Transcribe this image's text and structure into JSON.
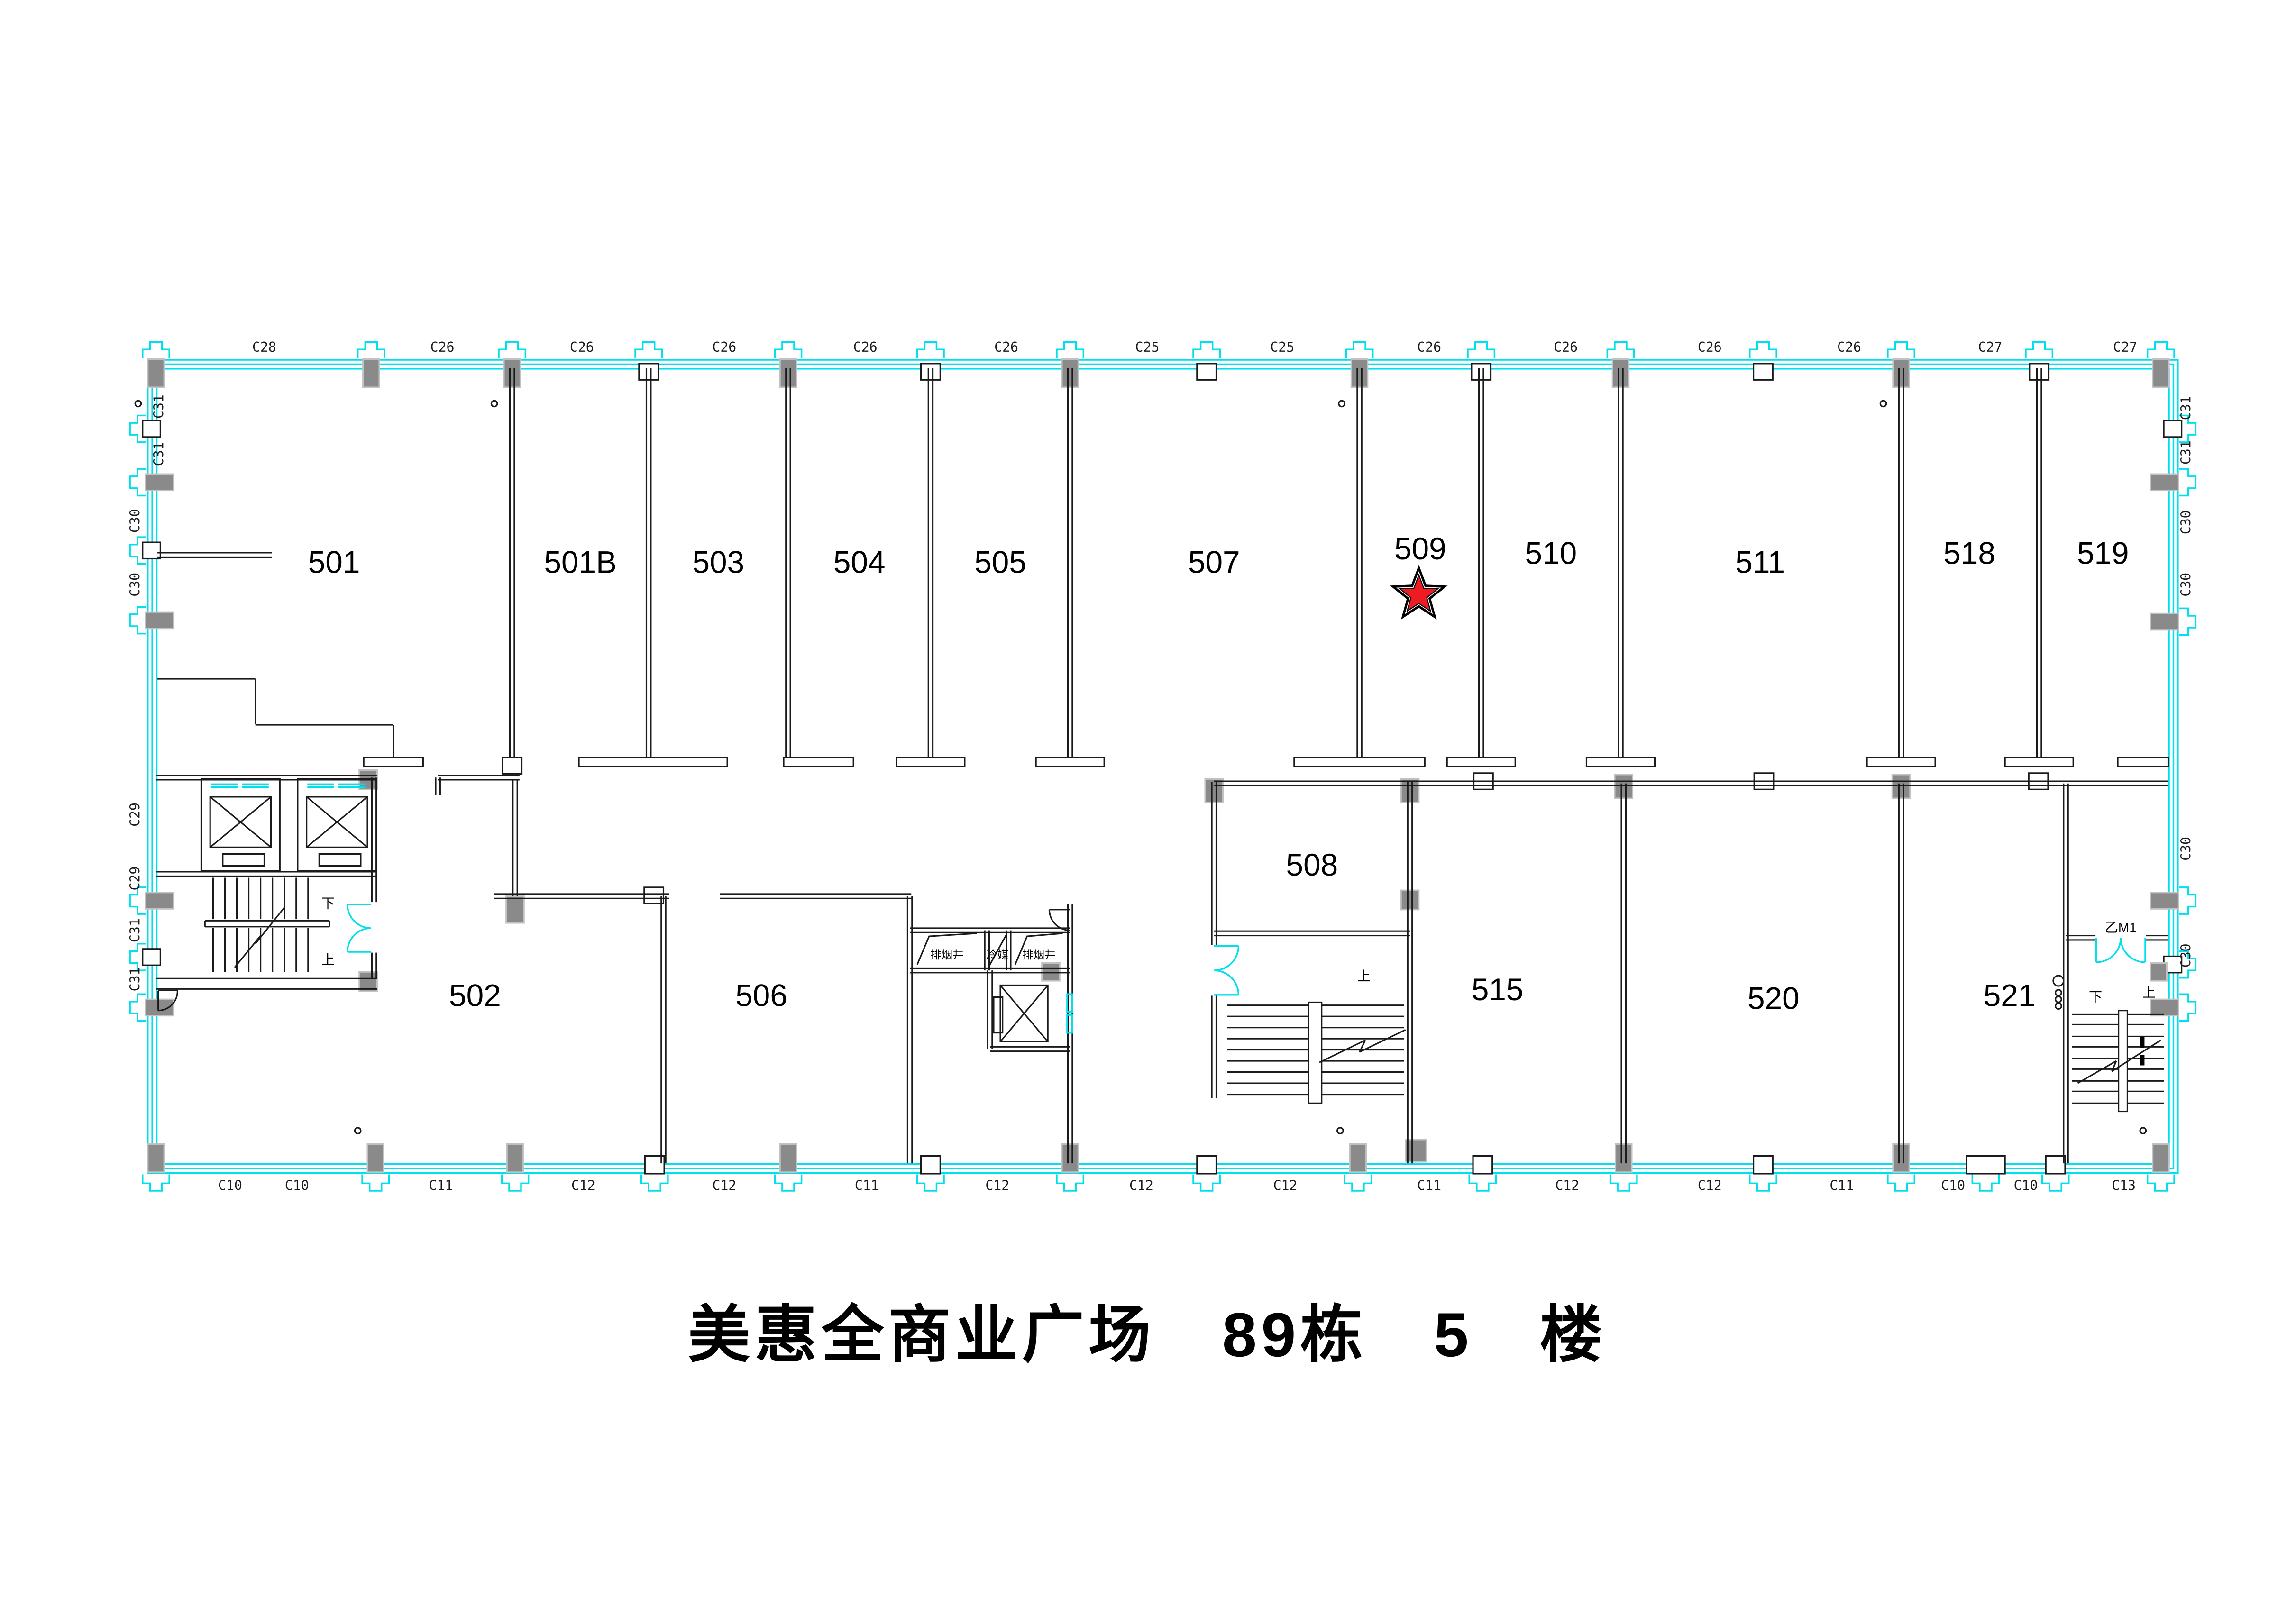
{
  "title": {
    "text": "美惠全商业广场　89栋　5　楼"
  },
  "marked_unit": "509",
  "rooms": {
    "top": [
      {
        "id": "501"
      },
      {
        "id": "501B"
      },
      {
        "id": "503"
      },
      {
        "id": "504"
      },
      {
        "id": "505"
      },
      {
        "id": "507"
      },
      {
        "id": "509",
        "marked": true
      },
      {
        "id": "510"
      },
      {
        "id": "511"
      },
      {
        "id": "518"
      },
      {
        "id": "519"
      }
    ],
    "bottom": [
      {
        "id": "502"
      },
      {
        "id": "506"
      },
      {
        "id": "508"
      },
      {
        "id": "515"
      },
      {
        "id": "520"
      },
      {
        "id": "521"
      }
    ]
  },
  "grid_labels": {
    "top": [
      {
        "t": "C28"
      },
      {
        "t": "C26"
      },
      {
        "t": "C26"
      },
      {
        "t": "C26"
      },
      {
        "t": "C26"
      },
      {
        "t": "C26"
      },
      {
        "t": "C25"
      },
      {
        "t": "C25"
      },
      {
        "t": "C26"
      },
      {
        "t": "C26"
      },
      {
        "t": "C26"
      },
      {
        "t": "C26"
      },
      {
        "t": "C27"
      },
      {
        "t": "C27"
      }
    ],
    "bottom": [
      {
        "t": "C10"
      },
      {
        "t": "C10"
      },
      {
        "t": "C11"
      },
      {
        "t": "C12"
      },
      {
        "t": "C12"
      },
      {
        "t": "C11"
      },
      {
        "t": "C12"
      },
      {
        "t": "C12"
      },
      {
        "t": "C12"
      },
      {
        "t": "C11"
      },
      {
        "t": "C12"
      },
      {
        "t": "C12"
      },
      {
        "t": "C11"
      },
      {
        "t": "C10"
      },
      {
        "t": "C10"
      },
      {
        "t": "C13"
      }
    ],
    "left": [
      {
        "t": "C31"
      },
      {
        "t": "C31"
      },
      {
        "t": "C30"
      },
      {
        "t": "C30"
      },
      {
        "t": "C29"
      },
      {
        "t": "C29"
      },
      {
        "t": "C31"
      },
      {
        "t": "C31"
      }
    ],
    "right": [
      {
        "t": "C31"
      },
      {
        "t": "C31"
      },
      {
        "t": "C30"
      },
      {
        "t": "C30"
      },
      {
        "t": "C30"
      },
      {
        "t": "C30"
      }
    ]
  },
  "annotations": {
    "up": "上",
    "down": "下",
    "fire_door": "乙M1",
    "shaft_smoke": "排烟井",
    "shaft_refrigerant": "冷媒"
  },
  "colors": {
    "wall": "#1a1a1a",
    "window_cyan": "#00dfee",
    "column_gray": "#8a8a8a",
    "star_red": "#ee1b23",
    "text": "#000000"
  }
}
